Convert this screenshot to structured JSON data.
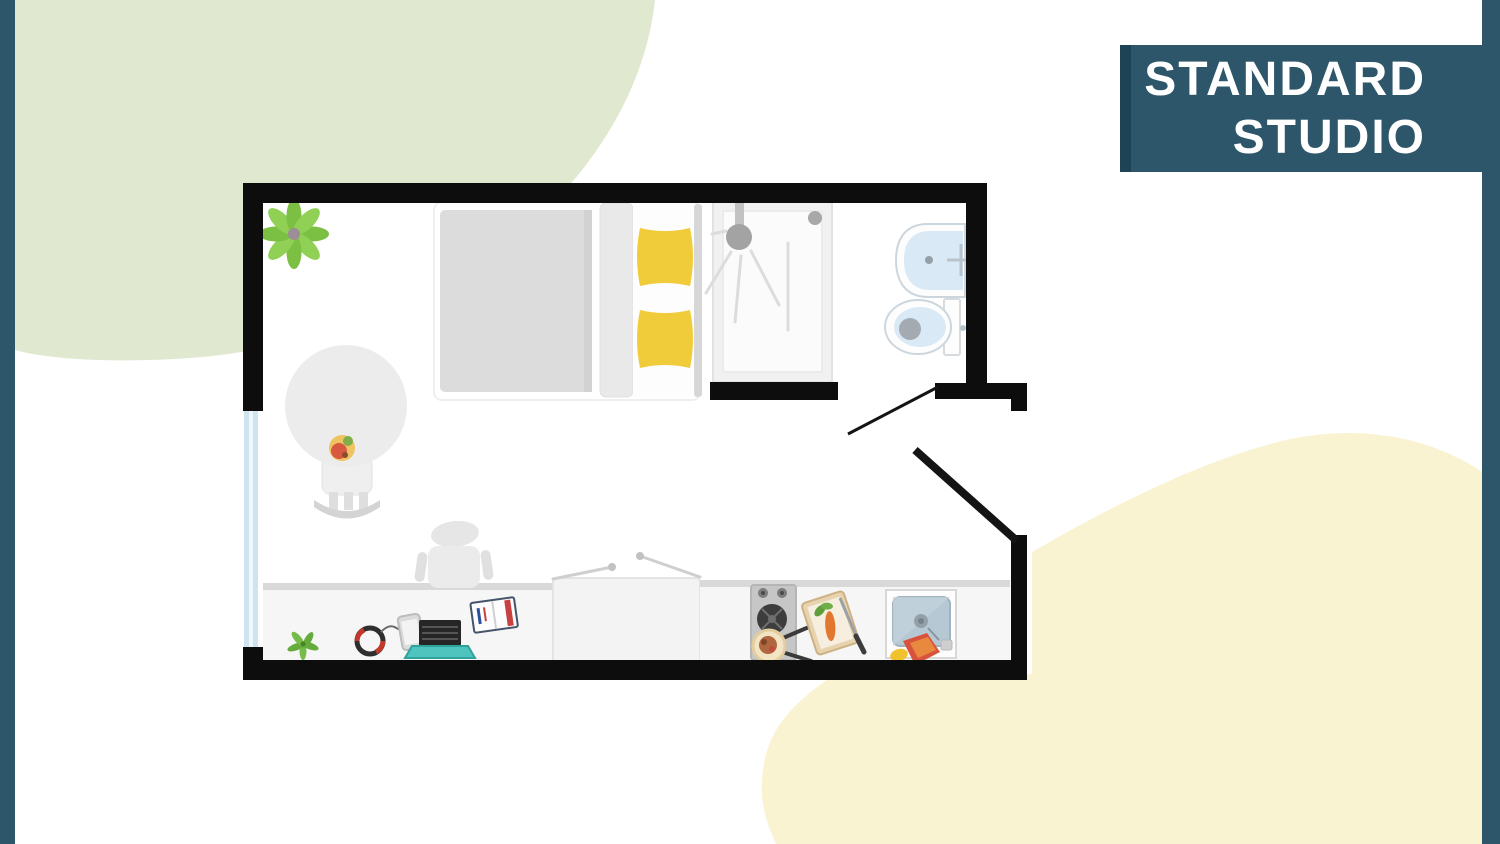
{
  "title": {
    "line1": "STANDARD",
    "line2": "STUDIO"
  },
  "colors": {
    "accent_teal": "#2e566a",
    "accent_teal_dark": "#1e4355",
    "blob_green": "#e0e8cf",
    "blob_yellow": "#faf3d2",
    "wall_black": "#0d0d0d",
    "window_blue": "#cfe4ee",
    "pillow_yellow": "#f1cc3a",
    "fixture_blue": "#d9e9f6",
    "laptop_teal": "#4fc3bd"
  },
  "floorplan": {
    "items": [
      "potted-plant",
      "bed",
      "duvet",
      "pillows",
      "armchair",
      "window",
      "shower",
      "wash-basin",
      "toilet",
      "bathroom-door",
      "entrance-door",
      "desk",
      "desk-chair",
      "laptop",
      "headphones",
      "phone",
      "notebook",
      "small-plant",
      "wardrobe",
      "kitchen-counter",
      "stove",
      "frying-pan",
      "cutting-board",
      "kitchen-sink",
      "dish-towel"
    ]
  }
}
